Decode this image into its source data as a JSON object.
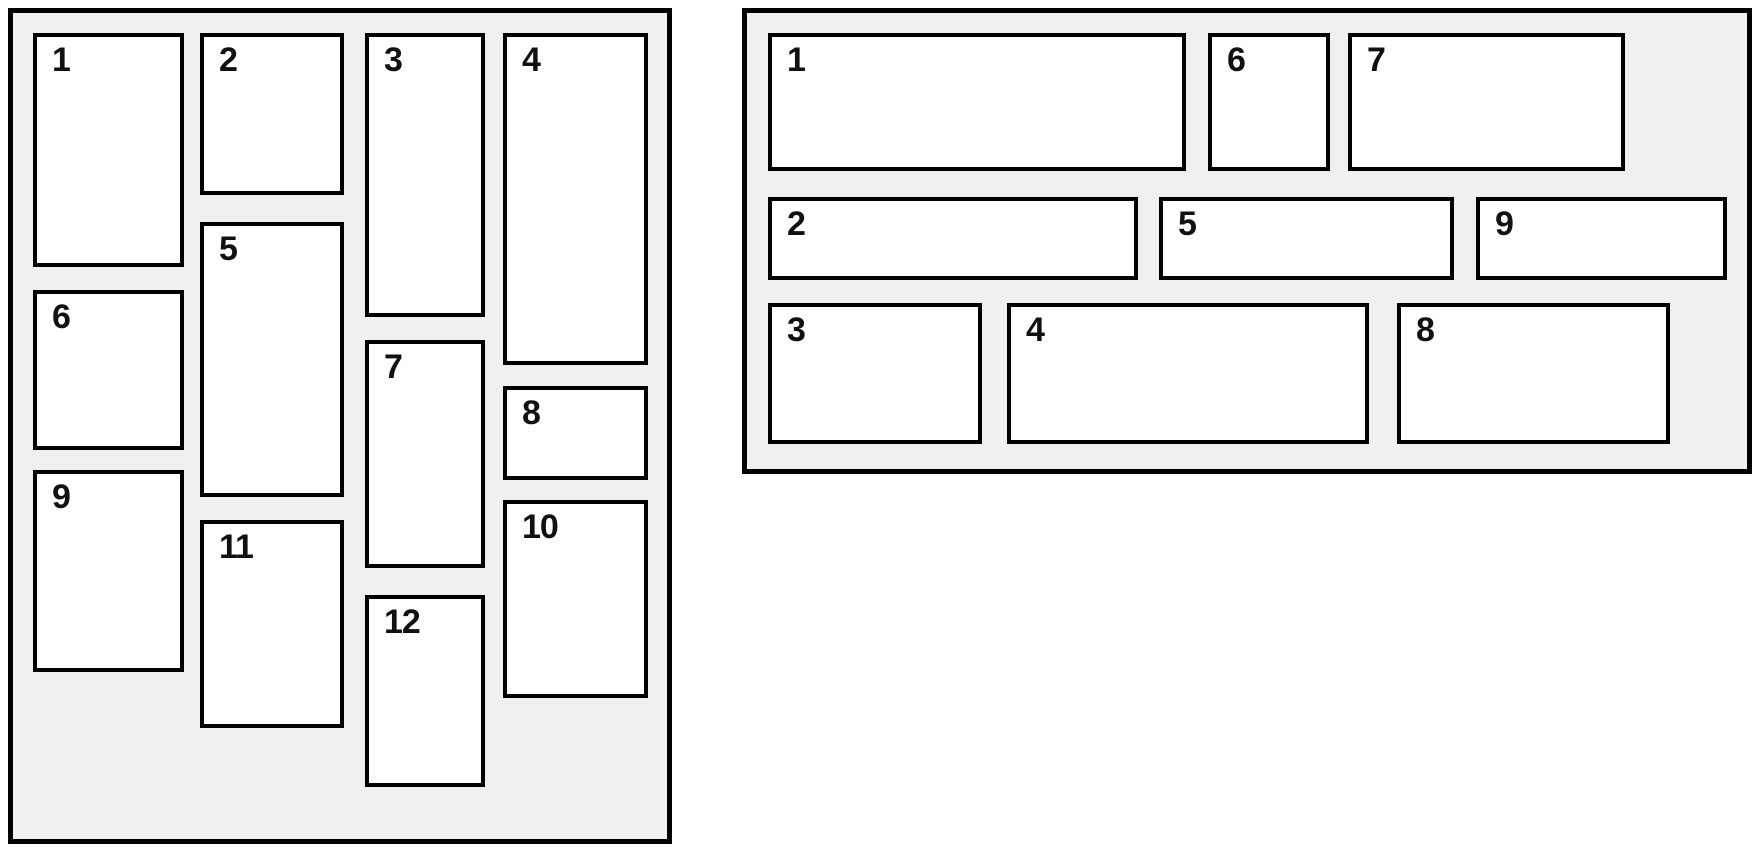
{
  "colors": {
    "page_bg": "#ffffff",
    "panel_bg": "#f0f0f0",
    "box_bg": "#ffffff",
    "line": "#000000",
    "label": "#111111"
  },
  "panels": [
    {
      "id": "vertical-masonry",
      "description": "column-flow masonry grid, 4 columns, 12 numbered tiles",
      "items": [
        {
          "label": "1",
          "x": 20,
          "y": 20,
          "w": 151,
          "h": 234
        },
        {
          "label": "2",
          "x": 187,
          "y": 20,
          "w": 144,
          "h": 162
        },
        {
          "label": "3",
          "x": 352,
          "y": 20,
          "w": 120,
          "h": 284
        },
        {
          "label": "4",
          "x": 490,
          "y": 20,
          "w": 145,
          "h": 332
        },
        {
          "label": "5",
          "x": 187,
          "y": 209,
          "w": 144,
          "h": 275
        },
        {
          "label": "6",
          "x": 20,
          "y": 277,
          "w": 151,
          "h": 160
        },
        {
          "label": "7",
          "x": 352,
          "y": 327,
          "w": 120,
          "h": 228
        },
        {
          "label": "8",
          "x": 490,
          "y": 373,
          "w": 145,
          "h": 94
        },
        {
          "label": "9",
          "x": 20,
          "y": 457,
          "w": 151,
          "h": 202
        },
        {
          "label": "10",
          "x": 490,
          "y": 487,
          "w": 145,
          "h": 198
        },
        {
          "label": "11",
          "x": 187,
          "y": 507,
          "w": 144,
          "h": 208
        },
        {
          "label": "12",
          "x": 352,
          "y": 582,
          "w": 120,
          "h": 192
        }
      ]
    },
    {
      "id": "horizontal-masonry",
      "description": "row-flow masonry grid, 3 rows, 9 numbered tiles",
      "items": [
        {
          "label": "1",
          "x": 21,
          "y": 20,
          "w": 418,
          "h": 138
        },
        {
          "label": "6",
          "x": 461,
          "y": 20,
          "w": 122,
          "h": 138
        },
        {
          "label": "7",
          "x": 601,
          "y": 20,
          "w": 277,
          "h": 138
        },
        {
          "label": "2",
          "x": 21,
          "y": 184,
          "w": 370,
          "h": 83
        },
        {
          "label": "5",
          "x": 412,
          "y": 184,
          "w": 295,
          "h": 83
        },
        {
          "label": "9",
          "x": 729,
          "y": 184,
          "w": 251,
          "h": 83
        },
        {
          "label": "3",
          "x": 21,
          "y": 290,
          "w": 214,
          "h": 141
        },
        {
          "label": "4",
          "x": 260,
          "y": 290,
          "w": 362,
          "h": 141
        },
        {
          "label": "8",
          "x": 650,
          "y": 290,
          "w": 273,
          "h": 141
        }
      ]
    }
  ]
}
